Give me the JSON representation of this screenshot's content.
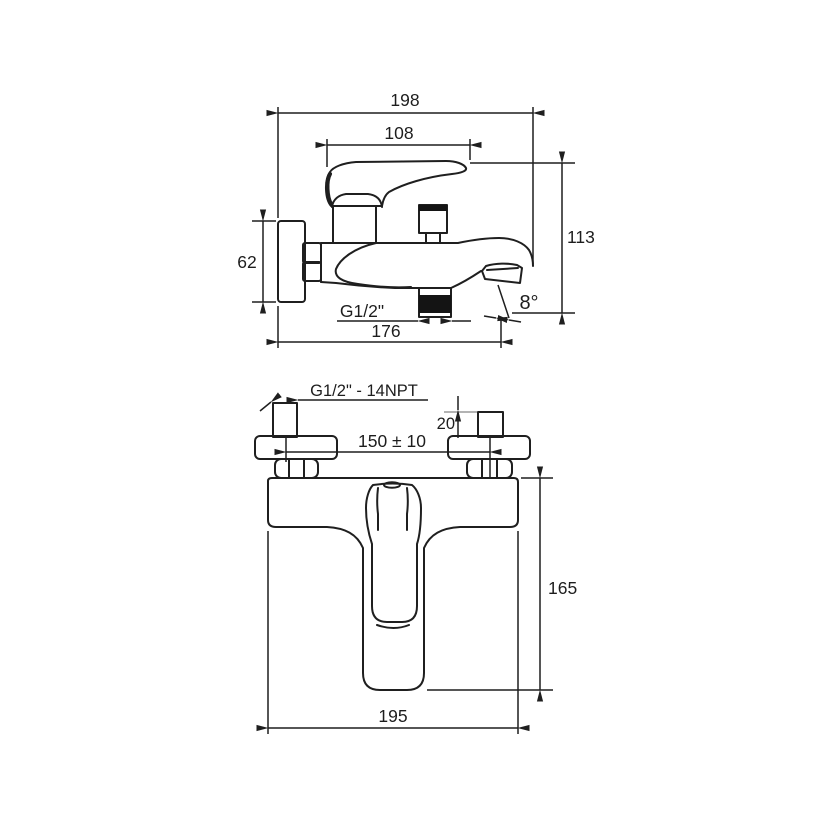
{
  "drawing": {
    "type": "faucet technical drawing, two orthographic views",
    "side_view": {
      "overall_width": "198",
      "handle_length": "108",
      "height_to_outlet": "113",
      "flange_height": "62",
      "shower_outlet_thread": "G1/2\"",
      "wall_to_spout": "176",
      "spout_angle": "8°"
    },
    "front_view": {
      "connection_thread": "G1/2\" - 14NPT",
      "inlet_pipe_length": "20",
      "center_distance": "150 ± 10",
      "body_height": "165",
      "body_width": "195"
    }
  }
}
